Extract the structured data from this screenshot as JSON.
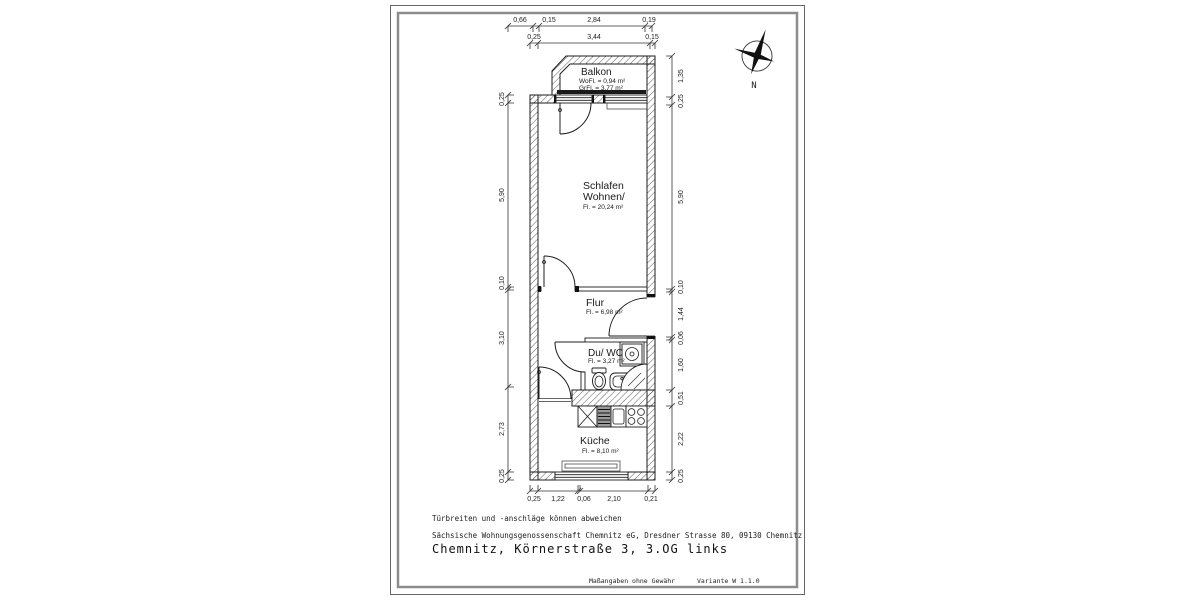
{
  "sheet": {
    "disclaimer": "Türbreiten und -anschläge können abweichen",
    "company_line": "Sächsische Wohnungsgenossenschaft Chemnitz eG, Dresdner Strasse 80, 09130 Chemnitz",
    "address_line": "Chemnitz, Körnerstraße 3, 3.OG links",
    "footer_note": "Maßangaben ohne Gewähr",
    "variant": "Variante W 1.1.0"
  },
  "compass": {
    "north_label": "N"
  },
  "rooms": {
    "balkon": {
      "name": "Balkon",
      "wofl": "WoFl. = 0,94 m²",
      "grfl": "GrFl. = 3,77 m²"
    },
    "schlafen_wohnen": {
      "name_line1": "Schlafen",
      "name_line2": "Wohnen/",
      "area": "Fl. = 20,24 m²"
    },
    "flur": {
      "name": "Flur",
      "area": "Fl. = 6,98 m²"
    },
    "du_wc": {
      "name": "Du/ WC",
      "area": "Fl. = 3,27 m²"
    },
    "kueche": {
      "name": "Küche",
      "area": "Fl. = 8,10 m²"
    }
  },
  "dimensions": {
    "top_row1": [
      "0,66",
      "0,15",
      "2,84",
      "0,19"
    ],
    "top_row2": [
      "0,25",
      "3,44",
      "0,15"
    ],
    "left": [
      "0,25",
      "5,90",
      "0,10",
      "3,10",
      "2,73",
      "0,25"
    ],
    "right": [
      "1,35",
      "0,25",
      "5,90",
      "0,10",
      "1,44",
      "0,06",
      "1,60",
      "0,51",
      "2,22",
      "0,25"
    ],
    "bottom": [
      "0,25",
      "1,22",
      "0,06",
      "2,10",
      "0,21"
    ]
  },
  "colors": {
    "line": "#1c1c1c",
    "border_inner": "#8c8c8c",
    "border_outer": "#666666"
  }
}
